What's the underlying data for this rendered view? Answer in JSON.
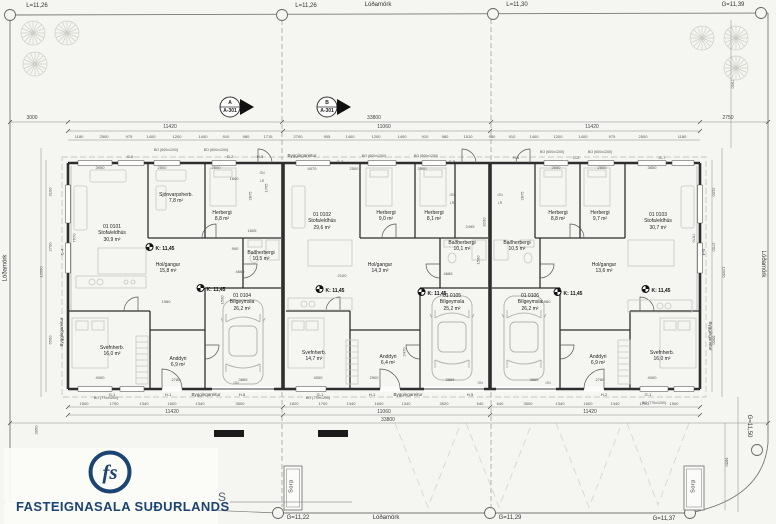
{
  "document": {
    "type": "architectural-floor-plan",
    "company": "FASTEIGNASALA SUÐURLANDS",
    "sheet_letter": "S"
  },
  "colors": {
    "ink": "#2e2e2e",
    "paper": "#f5f5f2",
    "logo_navy": "#1c4471",
    "furniture": "#c6c6c0"
  },
  "annotations": [
    {
      "t": "L=11,26",
      "x": 37,
      "y": 3,
      "c": "bnd"
    },
    {
      "t": "L=11,26",
      "x": 306,
      "y": 3,
      "c": "bnd"
    },
    {
      "t": "Lóðamörk",
      "x": 378,
      "y": 2,
      "c": "bnd"
    },
    {
      "t": "L=11,30",
      "x": 517,
      "y": 2,
      "c": "bnd"
    },
    {
      "t": "G=11,39",
      "x": 733,
      "y": 2,
      "c": "bnd"
    },
    {
      "t": "Lóðamörk",
      "x": 6,
      "y": 268,
      "c": "bnd",
      "r": -90
    },
    {
      "t": "Lóðamörk",
      "x": 762,
      "y": 264,
      "c": "bnd",
      "r": 90
    },
    {
      "t": "G=11,22",
      "x": 298,
      "y": 515,
      "c": "bnd"
    },
    {
      "t": "Lóðamörk",
      "x": 386,
      "y": 515,
      "c": "bnd"
    },
    {
      "t": "G=11,29",
      "x": 510,
      "y": 515,
      "c": "bnd"
    },
    {
      "t": "G=11,37",
      "x": 664,
      "y": 516,
      "c": "bnd"
    },
    {
      "t": "G=11,50",
      "x": 748,
      "y": 426,
      "c": "bnd",
      "r": 90
    },
    {
      "t": "(",
      "x": 5,
      "y": 499,
      "c": "bnd"
    },
    {
      "t": "A\nA-301",
      "x": 230,
      "y": 100,
      "c": "sec"
    },
    {
      "t": "B\nA-301",
      "x": 327,
      "y": 100,
      "c": "sec"
    },
    {
      "t": "3000",
      "x": 32,
      "y": 115,
      "c": "dim"
    },
    {
      "t": "33800",
      "x": 374,
      "y": 115,
      "c": "dim"
    },
    {
      "t": "2750",
      "x": 728,
      "y": 115,
      "c": "dim"
    },
    {
      "t": "11420",
      "x": 170,
      "y": 124,
      "c": "dim"
    },
    {
      "t": "11060",
      "x": 384,
      "y": 124,
      "c": "dim"
    },
    {
      "t": "11420",
      "x": 592,
      "y": 124,
      "c": "dim"
    },
    {
      "t": "11420",
      "x": 172,
      "y": 409,
      "c": "dim"
    },
    {
      "t": "11060",
      "x": 384,
      "y": 409,
      "c": "dim"
    },
    {
      "t": "11420",
      "x": 590,
      "y": 409,
      "c": "dim"
    },
    {
      "t": "33800",
      "x": 388,
      "y": 417,
      "c": "dim"
    },
    {
      "t": "1180",
      "x": 79,
      "y": 134,
      "c": "dims"
    },
    {
      "t": "2500",
      "x": 104,
      "y": 134,
      "c": "dims"
    },
    {
      "t": "975",
      "x": 129,
      "y": 134,
      "c": "dims"
    },
    {
      "t": "1400",
      "x": 151,
      "y": 134,
      "c": "dims"
    },
    {
      "t": "1200",
      "x": 177,
      "y": 134,
      "c": "dims"
    },
    {
      "t": "1400",
      "x": 203,
      "y": 134,
      "c": "dims"
    },
    {
      "t": "910",
      "x": 226,
      "y": 134,
      "c": "dims"
    },
    {
      "t": "980",
      "x": 246,
      "y": 134,
      "c": "dims"
    },
    {
      "t": "1715",
      "x": 268,
      "y": 134,
      "c": "dims"
    },
    {
      "t": "2700",
      "x": 298,
      "y": 134,
      "c": "dims"
    },
    {
      "t": "905",
      "x": 327,
      "y": 134,
      "c": "dims"
    },
    {
      "t": "1400",
      "x": 350,
      "y": 134,
      "c": "dims"
    },
    {
      "t": "1200",
      "x": 376,
      "y": 134,
      "c": "dims"
    },
    {
      "t": "1400",
      "x": 402,
      "y": 134,
      "c": "dims"
    },
    {
      "t": "910",
      "x": 425,
      "y": 134,
      "c": "dims"
    },
    {
      "t": "980",
      "x": 445,
      "y": 134,
      "c": "dims"
    },
    {
      "t": "1510",
      "x": 468,
      "y": 134,
      "c": "dims"
    },
    {
      "t": "980",
      "x": 492,
      "y": 134,
      "c": "dims"
    },
    {
      "t": "910",
      "x": 512,
      "y": 134,
      "c": "dims"
    },
    {
      "t": "1400",
      "x": 534,
      "y": 134,
      "c": "dims"
    },
    {
      "t": "1200",
      "x": 558,
      "y": 134,
      "c": "dims"
    },
    {
      "t": "1400",
      "x": 583,
      "y": 134,
      "c": "dims"
    },
    {
      "t": "975",
      "x": 612,
      "y": 134,
      "c": "dims"
    },
    {
      "t": "2500",
      "x": 643,
      "y": 134,
      "c": "dims"
    },
    {
      "t": "1180",
      "x": 682,
      "y": 134,
      "c": "dims"
    },
    {
      "t": "1500",
      "x": 84,
      "y": 401,
      "c": "dims"
    },
    {
      "t": "1700",
      "x": 114,
      "y": 401,
      "c": "dims"
    },
    {
      "t": "1340",
      "x": 144,
      "y": 401,
      "c": "dims"
    },
    {
      "t": "1600",
      "x": 172,
      "y": 401,
      "c": "dims"
    },
    {
      "t": "1340",
      "x": 200,
      "y": 401,
      "c": "dims"
    },
    {
      "t": "3500",
      "x": 240,
      "y": 401,
      "c": "dims"
    },
    {
      "t": "1820",
      "x": 294,
      "y": 401,
      "c": "dims"
    },
    {
      "t": "1700",
      "x": 323,
      "y": 401,
      "c": "dims"
    },
    {
      "t": "1340",
      "x": 351,
      "y": 401,
      "c": "dims"
    },
    {
      "t": "1600",
      "x": 379,
      "y": 401,
      "c": "dims"
    },
    {
      "t": "1340",
      "x": 406,
      "y": 401,
      "c": "dims"
    },
    {
      "t": "3520",
      "x": 444,
      "y": 401,
      "c": "dims"
    },
    {
      "t": "640",
      "x": 480,
      "y": 401,
      "c": "dims"
    },
    {
      "t": "640",
      "x": 500,
      "y": 401,
      "c": "dims"
    },
    {
      "t": "3500",
      "x": 528,
      "y": 401,
      "c": "dims"
    },
    {
      "t": "1340",
      "x": 560,
      "y": 401,
      "c": "dims"
    },
    {
      "t": "1600",
      "x": 588,
      "y": 401,
      "c": "dims"
    },
    {
      "t": "1340",
      "x": 615,
      "y": 401,
      "c": "dims"
    },
    {
      "t": "1700",
      "x": 644,
      "y": 401,
      "c": "dims"
    },
    {
      "t": "1500",
      "x": 674,
      "y": 401,
      "c": "dims"
    },
    {
      "t": "3100",
      "x": 50,
      "y": 192,
      "c": "dims",
      "r": -90
    },
    {
      "t": "2700",
      "x": 50,
      "y": 247,
      "c": "dims",
      "r": -90
    },
    {
      "t": "12950",
      "x": 41,
      "y": 272,
      "c": "dims",
      "r": -90
    },
    {
      "t": "6500",
      "x": 50,
      "y": 340,
      "c": "dims",
      "r": -90
    },
    {
      "t": "7670",
      "x": 74,
      "y": 238,
      "c": "dims",
      "r": -90
    },
    {
      "t": "3100",
      "x": 714,
      "y": 192,
      "c": "dims",
      "r": 90
    },
    {
      "t": "2700",
      "x": 714,
      "y": 247,
      "c": "dims",
      "r": 90
    },
    {
      "t": "12950",
      "x": 724,
      "y": 272,
      "c": "dims",
      "r": 90
    },
    {
      "t": "6500",
      "x": 714,
      "y": 340,
      "c": "dims",
      "r": 90
    },
    {
      "t": "7670",
      "x": 694,
      "y": 238,
      "c": "dims",
      "r": 90
    },
    {
      "t": "7900",
      "x": 733,
      "y": 84,
      "c": "dims",
      "r": 90
    },
    {
      "t": "6850",
      "x": 727,
      "y": 462,
      "c": "dims",
      "r": 90
    },
    {
      "t": "3950",
      "x": 36,
      "y": 430,
      "c": "dims",
      "r": -90
    },
    {
      "t": "G-4",
      "x": 62,
      "y": 252,
      "c": "grid",
      "r": -90
    },
    {
      "t": "G-4",
      "x": 704,
      "y": 252,
      "c": "grid",
      "r": 90
    },
    {
      "t": "BO (600x1200)",
      "x": 166,
      "y": 148,
      "c": "bo"
    },
    {
      "t": "BO (600x1200)",
      "x": 216,
      "y": 148,
      "c": "bo"
    },
    {
      "t": "BO (600x1200)",
      "x": 374,
      "y": 154,
      "c": "bo"
    },
    {
      "t": "BO (600x1200)",
      "x": 426,
      "y": 154,
      "c": "bo"
    },
    {
      "t": "BO (600x1200)",
      "x": 552,
      "y": 150,
      "c": "bo"
    },
    {
      "t": "BO (600x1200)",
      "x": 600,
      "y": 150,
      "c": "bo"
    },
    {
      "t": "BO (770x1200)",
      "x": 106,
      "y": 396,
      "c": "bo"
    },
    {
      "t": "BO (770x1200)",
      "x": 318,
      "y": 396,
      "c": "bo"
    },
    {
      "t": "BO (770x1200)",
      "x": 654,
      "y": 401,
      "c": "bo"
    },
    {
      "t": "G-6",
      "x": 130,
      "y": 154,
      "c": "grid"
    },
    {
      "t": "G-2",
      "x": 230,
      "y": 154,
      "c": "grid"
    },
    {
      "t": "H-3",
      "x": 260,
      "y": 154,
      "c": "grid"
    },
    {
      "t": "G-2",
      "x": 340,
      "y": 159,
      "c": "grid"
    },
    {
      "t": "G-5",
      "x": 452,
      "y": 159,
      "c": "grid"
    },
    {
      "t": "H-4",
      "x": 516,
      "y": 155,
      "c": "grid"
    },
    {
      "t": "G-2",
      "x": 576,
      "y": 155,
      "c": "grid"
    },
    {
      "t": "G-7",
      "x": 662,
      "y": 155,
      "c": "grid"
    },
    {
      "t": "G-1",
      "x": 112,
      "y": 392,
      "c": "grid"
    },
    {
      "t": "H-1",
      "x": 168,
      "y": 392,
      "c": "grid"
    },
    {
      "t": "H-5",
      "x": 242,
      "y": 392,
      "c": "grid"
    },
    {
      "t": "G-1",
      "x": 320,
      "y": 392,
      "c": "grid"
    },
    {
      "t": "H-1",
      "x": 372,
      "y": 392,
      "c": "grid"
    },
    {
      "t": "H-5",
      "x": 470,
      "y": 392,
      "c": "grid"
    },
    {
      "t": "H-2",
      "x": 604,
      "y": 392,
      "c": "grid"
    },
    {
      "t": "G-1",
      "x": 648,
      "y": 392,
      "c": "grid"
    },
    {
      "t": "Byggingareitur",
      "x": 302,
      "y": 153,
      "c": "byg"
    },
    {
      "t": "Byggingareitur",
      "x": 206,
      "y": 392,
      "c": "byg"
    },
    {
      "t": "Byggingareitur",
      "x": 408,
      "y": 392,
      "c": "byg"
    },
    {
      "t": "Byggingareitur",
      "x": 62,
      "y": 332,
      "c": "byg",
      "r": -90
    },
    {
      "t": "Byggingareitur",
      "x": 710,
      "y": 336,
      "c": "byg",
      "r": 90
    },
    {
      "t": "01 0101\nStofa/eldhús\n30,9 m²",
      "x": 112,
      "y": 224,
      "c": "room"
    },
    {
      "t": "Sjónvarpsherb.\n7,8 m²",
      "x": 176,
      "y": 192,
      "c": "room"
    },
    {
      "t": "Herbergi\n8,8 m²",
      "x": 222,
      "y": 210,
      "c": "room"
    },
    {
      "t": "Baðherbergi\n10,5 m²",
      "x": 261,
      "y": 250,
      "c": "room"
    },
    {
      "t": "Hol/gangur\n15,8 m²",
      "x": 168,
      "y": 262,
      "c": "room"
    },
    {
      "t": "Svefnherb.\n16,0 m²",
      "x": 112,
      "y": 345,
      "c": "room"
    },
    {
      "t": "Anddyri\n6,9 m²",
      "x": 178,
      "y": 356,
      "c": "room"
    },
    {
      "t": "01 0104\nBílgeymsla\n26,2 m²",
      "x": 242,
      "y": 293,
      "c": "room"
    },
    {
      "t": "01 0102\nStofa/eldhús\n29,6 m²",
      "x": 322,
      "y": 212,
      "c": "room"
    },
    {
      "t": "Herbergi\n9,0 m²",
      "x": 386,
      "y": 210,
      "c": "room"
    },
    {
      "t": "Herbergi\n8,1 m²",
      "x": 434,
      "y": 210,
      "c": "room"
    },
    {
      "t": "Baðherbergi\n10,1 m²",
      "x": 462,
      "y": 240,
      "c": "room"
    },
    {
      "t": "Hol/gangur\n14,3 m²",
      "x": 380,
      "y": 262,
      "c": "room"
    },
    {
      "t": "Svefnherb.\n14,7 m²",
      "x": 314,
      "y": 350,
      "c": "room"
    },
    {
      "t": "Anddyri\n6,4 m²",
      "x": 388,
      "y": 354,
      "c": "room"
    },
    {
      "t": "01 0105\nBílgeymsla\n25,2 m²",
      "x": 452,
      "y": 293,
      "c": "room"
    },
    {
      "t": "01 0103\nStofa/eldhús\n30,7 m²",
      "x": 658,
      "y": 212,
      "c": "room"
    },
    {
      "t": "Herbergi\n8,8 m²",
      "x": 558,
      "y": 210,
      "c": "room"
    },
    {
      "t": "Herbergi\n9,7 m²",
      "x": 600,
      "y": 210,
      "c": "room"
    },
    {
      "t": "Baðherbergi\n10,5 m²",
      "x": 517,
      "y": 240,
      "c": "room"
    },
    {
      "t": "Hol/gangur\n13,6 m²",
      "x": 604,
      "y": 262,
      "c": "room"
    },
    {
      "t": "Svefnherb.\n16,0 m²",
      "x": 662,
      "y": 350,
      "c": "room"
    },
    {
      "t": "Anddyri\n6,9 m²",
      "x": 598,
      "y": 354,
      "c": "room"
    },
    {
      "t": "01 0106\nBílgeymsla\n26,2 m²",
      "x": 530,
      "y": 293,
      "c": "room"
    },
    {
      "t": "K: 11,45",
      "x": 160,
      "y": 243,
      "c": "k"
    },
    {
      "t": "K: 11,45",
      "x": 211,
      "y": 284,
      "c": "k"
    },
    {
      "t": "K: 11,45",
      "x": 330,
      "y": 285,
      "c": "k"
    },
    {
      "t": "K: 11,45",
      "x": 432,
      "y": 288,
      "c": "k"
    },
    {
      "t": "K: 11,45",
      "x": 568,
      "y": 288,
      "c": "k"
    },
    {
      "t": "K: 11,45",
      "x": 656,
      "y": 285,
      "c": "k"
    },
    {
      "t": "Sorp",
      "x": 292,
      "y": 486,
      "c": "sorp",
      "r": -90
    },
    {
      "t": "Sorp",
      "x": 694,
      "y": 486,
      "c": "sorp",
      "r": -90
    },
    {
      "t": "3950",
      "x": 100,
      "y": 165,
      "c": "dims"
    },
    {
      "t": "2500",
      "x": 162,
      "y": 165,
      "c": "dims"
    },
    {
      "t": "2500",
      "x": 216,
      "y": 165,
      "c": "dims"
    },
    {
      "t": "4070",
      "x": 312,
      "y": 166,
      "c": "dims"
    },
    {
      "t": "2500",
      "x": 354,
      "y": 166,
      "c": "dims"
    },
    {
      "t": "2500",
      "x": 422,
      "y": 166,
      "c": "dims"
    },
    {
      "t": "2500",
      "x": 556,
      "y": 165,
      "c": "dims"
    },
    {
      "t": "2500",
      "x": 602,
      "y": 165,
      "c": "dims"
    },
    {
      "t": "3850",
      "x": 652,
      "y": 165,
      "c": "dims"
    },
    {
      "t": "2100",
      "x": 342,
      "y": 273,
      "c": "dims"
    },
    {
      "t": "1980",
      "x": 166,
      "y": 299,
      "c": "dims"
    },
    {
      "t": "1980",
      "x": 546,
      "y": 299,
      "c": "dims"
    },
    {
      "t": "4665",
      "x": 240,
      "y": 269,
      "c": "dims"
    },
    {
      "t": "4665",
      "x": 448,
      "y": 271,
      "c": "dims"
    },
    {
      "t": "4000",
      "x": 100,
      "y": 375,
      "c": "dims"
    },
    {
      "t": "2780",
      "x": 176,
      "y": 377,
      "c": "dims"
    },
    {
      "t": "3865",
      "x": 243,
      "y": 377,
      "c": "dims"
    },
    {
      "t": "4000",
      "x": 318,
      "y": 375,
      "c": "dims"
    },
    {
      "t": "2900",
      "x": 374,
      "y": 375,
      "c": "dims"
    },
    {
      "t": "3865",
      "x": 450,
      "y": 377,
      "c": "dims"
    },
    {
      "t": "3865",
      "x": 534,
      "y": 377,
      "c": "dims"
    },
    {
      "t": "2780",
      "x": 600,
      "y": 377,
      "c": "dims"
    },
    {
      "t": "4000",
      "x": 652,
      "y": 375,
      "c": "dims"
    },
    {
      "t": "2875",
      "x": 250,
      "y": 196,
      "c": "dims",
      "r": -90
    },
    {
      "t": "2875",
      "x": 522,
      "y": 196,
      "c": "dims",
      "r": -90
    },
    {
      "t": "1765",
      "x": 266,
      "y": 188,
      "c": "dims",
      "r": -90
    },
    {
      "t": "2495",
      "x": 470,
      "y": 224,
      "c": "dims"
    },
    {
      "t": "2470",
      "x": 404,
      "y": 352,
      "c": "dims",
      "r": -90
    },
    {
      "t": "1500",
      "x": 478,
      "y": 260,
      "c": "dims",
      "r": -90
    },
    {
      "t": "1500",
      "x": 222,
      "y": 300,
      "c": "dims",
      "r": -90
    },
    {
      "t": "900",
      "x": 235,
      "y": 246,
      "c": "dims"
    },
    {
      "t": "1605",
      "x": 252,
      "y": 228,
      "c": "dims"
    },
    {
      "t": "1600",
      "x": 234,
      "y": 176,
      "c": "dims"
    },
    {
      "t": "8230",
      "x": 484,
      "y": 222,
      "c": "dims",
      "r": -90
    },
    {
      "t": "GN",
      "x": 262,
      "y": 171,
      "c": "tiny"
    },
    {
      "t": "LR",
      "x": 262,
      "y": 179,
      "c": "tiny"
    },
    {
      "t": "GN",
      "x": 452,
      "y": 193,
      "c": "tiny"
    },
    {
      "t": "LR",
      "x": 452,
      "y": 201,
      "c": "tiny"
    },
    {
      "t": "GN",
      "x": 500,
      "y": 193,
      "c": "tiny"
    },
    {
      "t": "LR",
      "x": 500,
      "y": 201,
      "c": "tiny"
    },
    {
      "t": "GN",
      "x": 236,
      "y": 381,
      "c": "tiny"
    },
    {
      "t": "GN",
      "x": 480,
      "y": 381,
      "c": "tiny"
    },
    {
      "t": "GN",
      "x": 548,
      "y": 381,
      "c": "tiny"
    },
    {
      "t": "S",
      "x": 222,
      "y": 490,
      "c": "slabel"
    }
  ]
}
